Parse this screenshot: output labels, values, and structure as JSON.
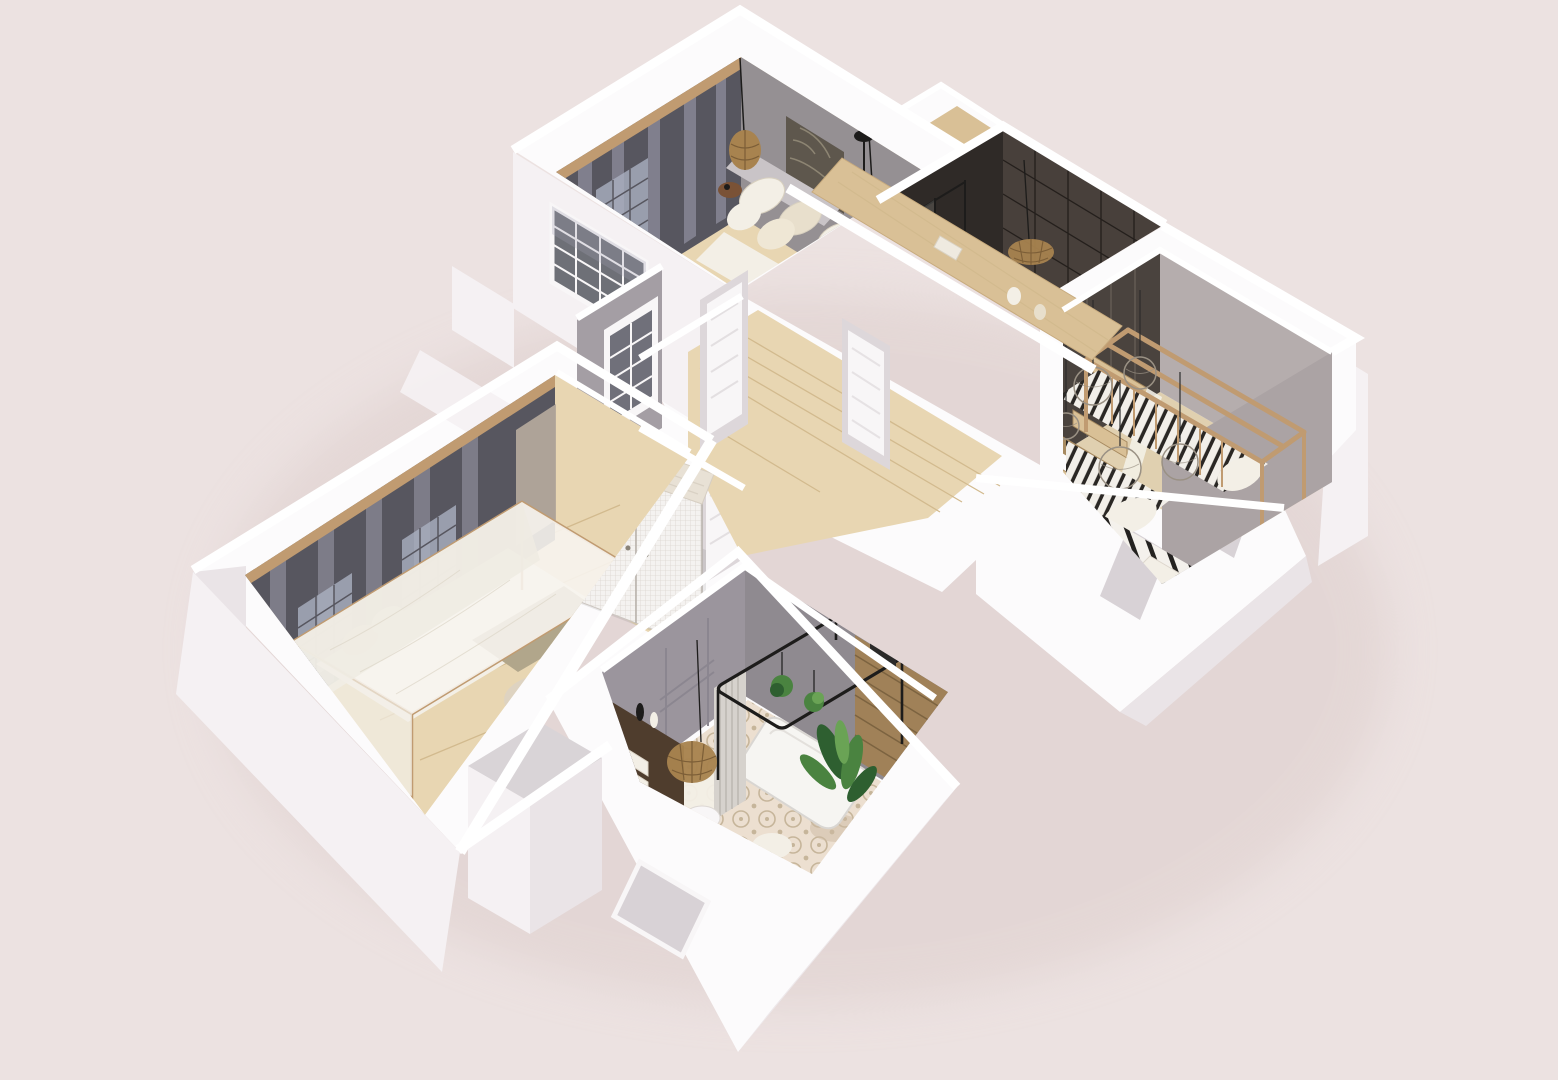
{
  "scene": {
    "type": "3d-floor-plan-render",
    "description": "Isometric cut-away 3D render of a furnished apartment viewed from above on a plain dusty-pink background",
    "style": "white cut walls, grey feature walls, light wood floors, scandinavian furniture",
    "rooms": [
      {
        "id": "living-room",
        "location": "top",
        "features": [
          "dark grey curtain wall",
          "wood top rail",
          "grey wall with framed art",
          "daybed sofa with white and beige cushions",
          "rattan pendant light",
          "black table lamp",
          "black pendant light",
          "wood console bar",
          "dark wood side stool"
        ]
      },
      {
        "id": "shower-room",
        "location": "top-right",
        "features": [
          "dark brown tiled walls",
          "black framed glass partition",
          "round white basin tub",
          "potted plant",
          "woven rattan pendant"
        ]
      },
      {
        "id": "kids-bedroom",
        "location": "right",
        "features": [
          "wooden house-frame bunk bed",
          "black and white striped bedding",
          "wooden staircase",
          "five rattan ball pendant lamps",
          "zebra stripe rug",
          "dark wardrobe wall",
          "small white desk",
          "two window openings"
        ]
      },
      {
        "id": "hallway",
        "location": "center",
        "features": [
          "light wood plank floor",
          "white panelled doors",
          "internal glazed window",
          "tall black-grid glazing"
        ]
      },
      {
        "id": "dressing-nook",
        "location": "center-left",
        "features": [
          "mesh-front wardrobe with whitewashed wood top",
          "white slatted shelf ladder"
        ]
      },
      {
        "id": "master-bedroom",
        "location": "left",
        "features": [
          "dark grey wall with sheer curtains",
          "wood top rail",
          "four-poster canopy bed with sheer white drape",
          "olive throw blanket",
          "round jute rug",
          "beige curtain"
        ]
      },
      {
        "id": "bathroom",
        "location": "bottom",
        "features": [
          "grey walls",
          "wood slat wall",
          "black metal canopy frame over white bathtub",
          "pleated shower curtain",
          "two hanging plants",
          "patterned encaustic tile floor",
          "dark wood shelf with rolled towels and bottles",
          "rattan basket pendant",
          "white basin",
          "large potted plant",
          "window opening"
        ]
      }
    ],
    "exterior": [
      "white cut-away wall slabs",
      "chimney notch with wood floor",
      "stepped lower-right wing with two window openings",
      "soft ground shadow"
    ]
  },
  "palette": {
    "bg": "#ece2e1",
    "blockWhite": "#fcfbfc",
    "bandWhite": "#ffffff",
    "slabLight": "#f5f1f3",
    "slabShade": "#eae4e7",
    "slabDark": "#d8d2d6",
    "wallFace": "#ddd7da",
    "doorWhite": "#f8f6f7",
    "grayTop": "#d9d4d7",
    "darkWall": "#57565f",
    "curtainLight": "#a3a2b2",
    "winLight": "#aab0c0",
    "beigeCurtain": "#b3a89b",
    "woodRail": "#c09b71",
    "woodFloor": "#e8d6b2",
    "woodMid": "#d9c096",
    "woodDark": "#a78a60",
    "woodWhite": "#e8e1d5",
    "plankLine": "#d2ba8e",
    "loungeWallGray": "#959093",
    "artDark": "#5e574d",
    "tileWall": "#48403b",
    "tileWallDeep": "#2f2a27",
    "tileLine": "#241f1c",
    "grayWall": "#b5adad",
    "bathWall": "#9b959d",
    "slatWood": "#a08158",
    "slatLine": "#7c6340",
    "shelfWood": "#4f3d2d",
    "linen": "#f3efe6",
    "cream": "#e8dfcc",
    "olive": "#b1a68b",
    "rugBeige": "#ddd3c2",
    "tileFloor": "#ecdfd0",
    "tileOrn": "#c6b59a",
    "black": "#1d1c1b",
    "plantDark": "#2e5f30",
    "plant": "#4a8340",
    "plantLight": "#6aa355",
    "rattan": "#a8834f",
    "rattanDeep": "#7c5e37",
    "ballGray": "#cfc8be",
    "ballGrayDeep": "#9a9184",
    "glass": "#6e7077",
    "shadow": "#dcccca",
    "mistWhite": "#f2efe9"
  }
}
